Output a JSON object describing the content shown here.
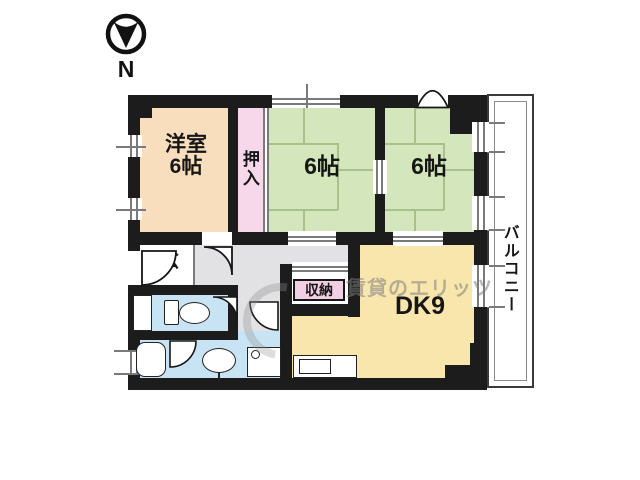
{
  "compass": {
    "label": "N"
  },
  "watermark": {
    "text": "賃貸のエリッツ"
  },
  "rooms": {
    "western": {
      "name": "洋室",
      "size": "6帖",
      "color": "#f8debc"
    },
    "oshiire": {
      "label": "押入",
      "color": "#f6d8ea"
    },
    "tatami1": {
      "label": "6帖",
      "color": "#d4e6bb"
    },
    "tatami2": {
      "label": "6帖",
      "color": "#d4e6bb"
    },
    "dk": {
      "label": "DK9",
      "color": "#f8e6ad"
    },
    "storage": {
      "label": "収納",
      "color": "#f3cfe3"
    },
    "entrance": {
      "label": "玄",
      "color": "#ffffff"
    },
    "balcony": {
      "label": "バルコニー",
      "color": "#ffffff"
    },
    "hall": {
      "color": "#e2e1e3"
    },
    "toilet": {
      "color": "#c8e4f4"
    },
    "bathroom": {
      "color": "#c8e4f4"
    },
    "washroom": {
      "color": "#c8e4f4"
    },
    "kitchen": {
      "color": "#f8e6ad"
    }
  },
  "colors": {
    "wall": "#1c1c1c",
    "tatami_line": "#a8c18a",
    "window_line": "#7a7a7a"
  }
}
